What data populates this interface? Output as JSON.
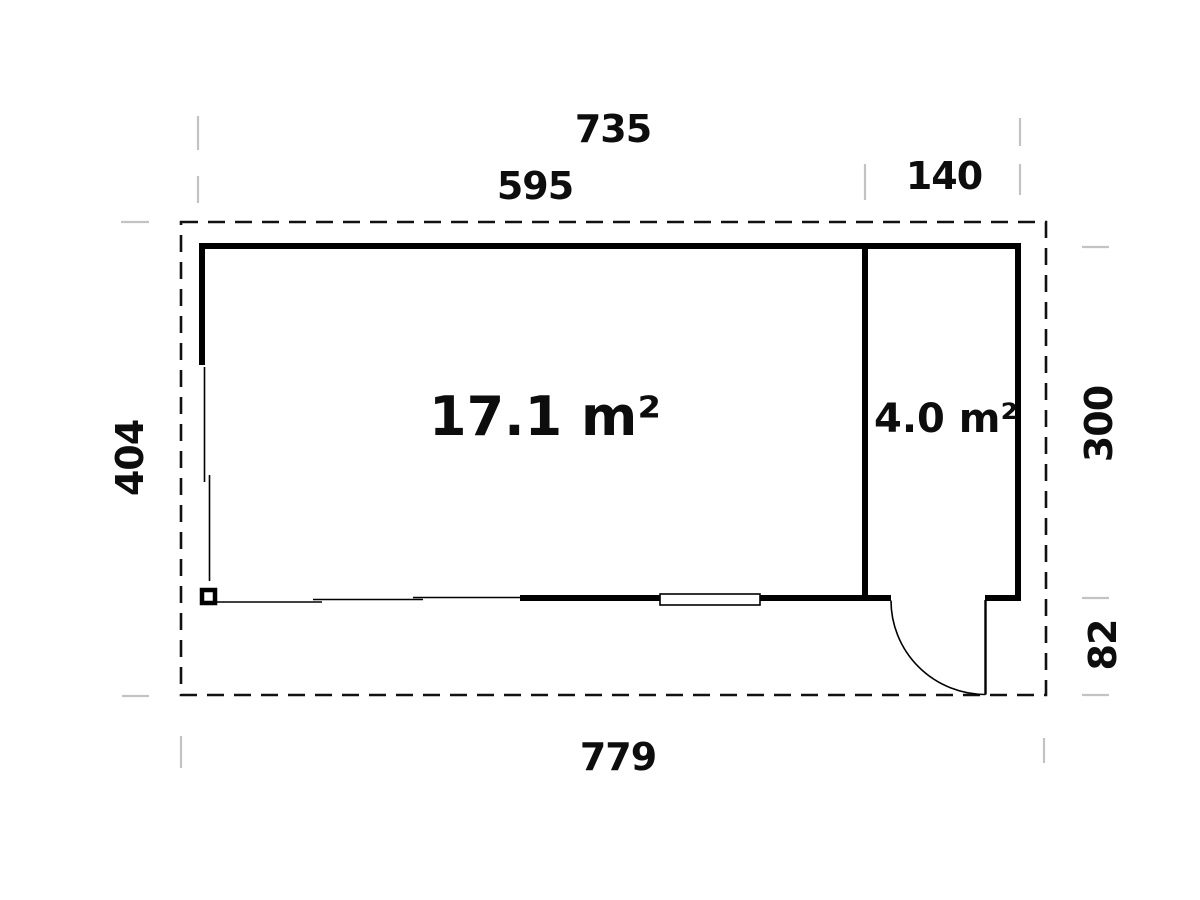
{
  "colors": {
    "line": "#000000",
    "dashed_outline": "#111111",
    "tick": "#c3c3c3",
    "background": "#ffffff",
    "text": "#0d0d0d"
  },
  "rooms": {
    "main": {
      "area_label": "17.1 m²"
    },
    "side": {
      "area_label": "4.0 m²"
    }
  },
  "dimensions": {
    "top_overall": "735",
    "top_main": "595",
    "top_side": "140",
    "left_depth": "404",
    "right_depth": "300",
    "right_porch": "82",
    "bottom_overall": "779"
  }
}
